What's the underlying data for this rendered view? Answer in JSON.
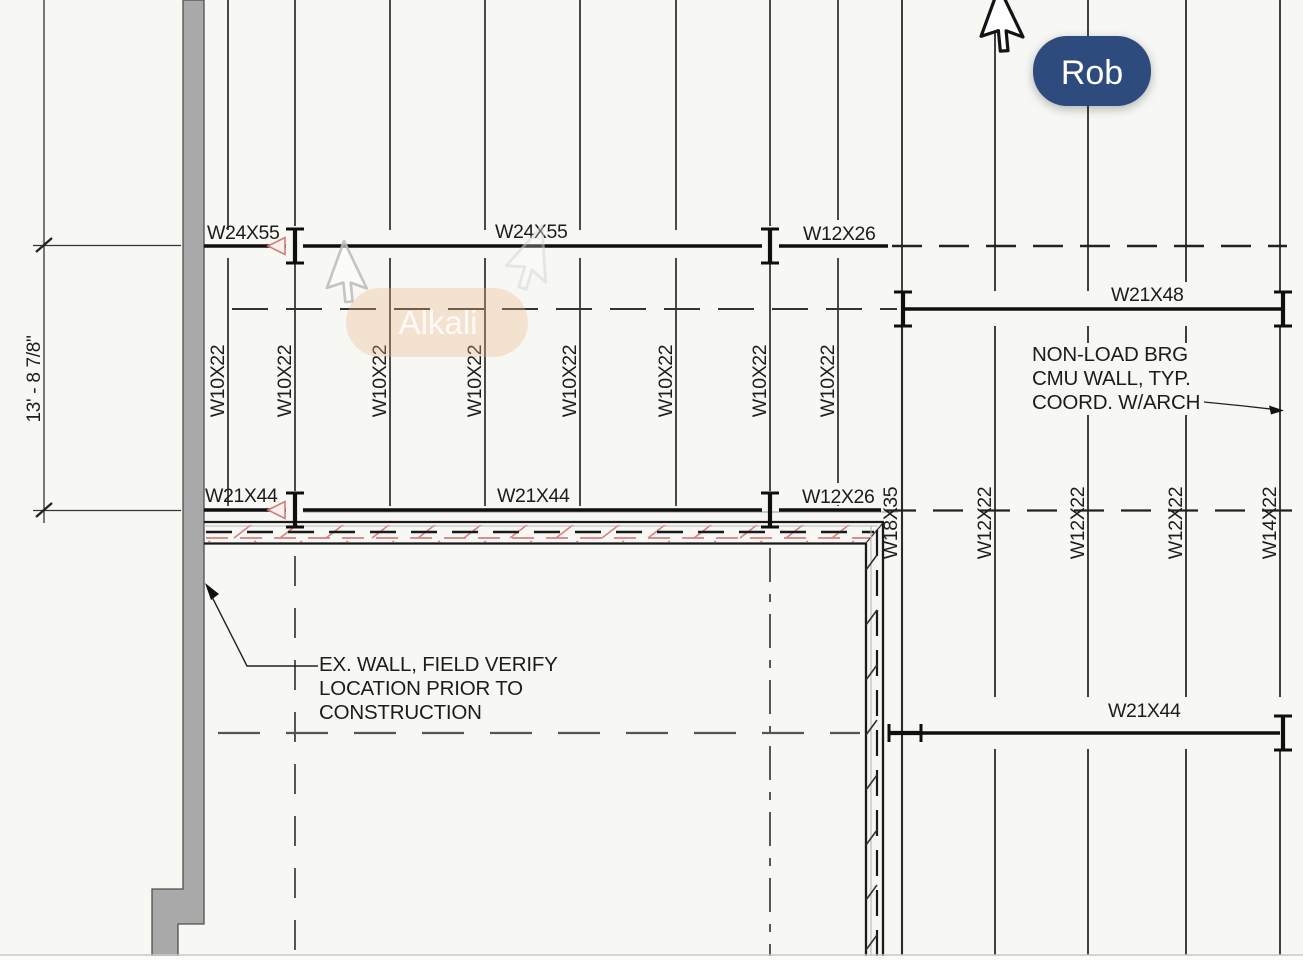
{
  "drawing": {
    "title": "structural-framing-plan",
    "colors": {
      "background": "#f7f7f4",
      "line": "#1c1c1c",
      "wall_gray": "#a9a9a9",
      "accent_red": "#d98080",
      "badge_rob": "#2e4b7d",
      "badge_alkali": "#f6dcc4"
    },
    "beams": {
      "top_left": "W24X55",
      "top_center": "W24X55",
      "top_right": "W12X26",
      "right_upper": "W21X48",
      "mid_left": "W21X44",
      "mid_center": "W21X44",
      "mid_right": "W12X26",
      "right_lower": "W21X44"
    },
    "joists": [
      "W10X22",
      "W10X22",
      "W10X22",
      "W10X22",
      "W10X22",
      "W10X22",
      "W10X22",
      "W10X22"
    ],
    "stub_beam": "W18X35",
    "infill_beams": [
      "W12X22",
      "W12X22",
      "W12X22",
      "W14X22"
    ],
    "dimension_text": "13' - 8 7/8\"",
    "notes": {
      "cmu_line1": "NON-LOAD BRG",
      "cmu_line2": "CMU WALL, TYP.",
      "cmu_line3": "COORD. W/ARCH",
      "exwall_line1": "EX. WALL, FIELD VERIFY",
      "exwall_line2": "LOCATION PRIOR TO",
      "exwall_line3": "CONSTRUCTION"
    }
  },
  "collaborators": {
    "rob": {
      "name": "Rob"
    },
    "alkali": {
      "name": "Alkali"
    }
  }
}
